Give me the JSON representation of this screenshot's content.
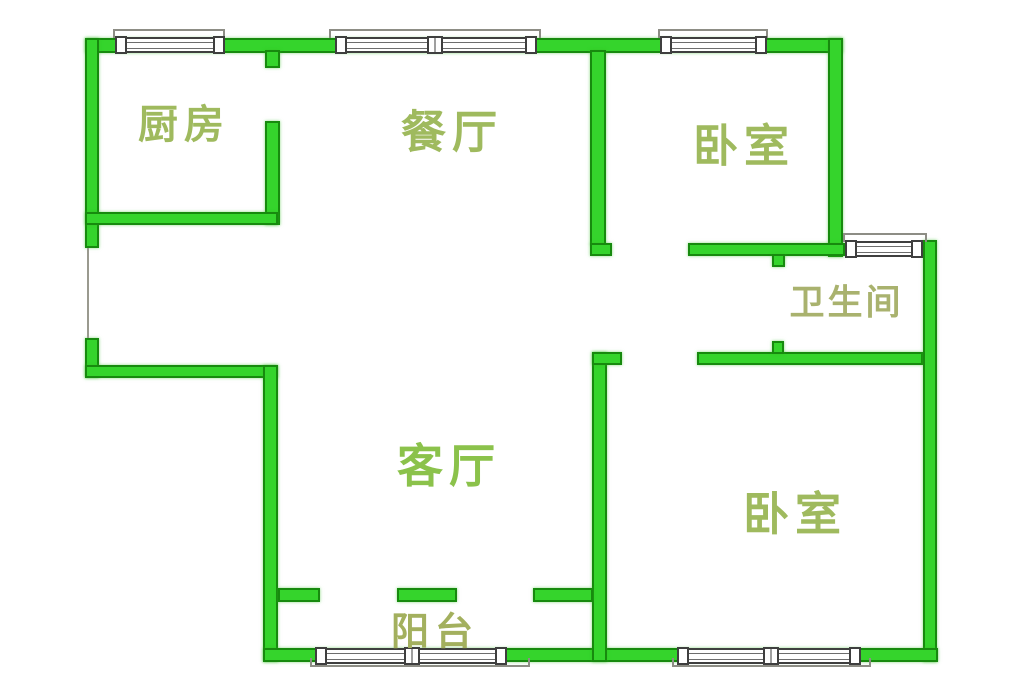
{
  "plan_title": "apartment-floor-plan",
  "rooms": [
    {
      "id": "kitchen",
      "label": "厨房"
    },
    {
      "id": "dining-room",
      "label": "餐厅"
    },
    {
      "id": "bedroom-top",
      "label": "卧室"
    },
    {
      "id": "bathroom",
      "label": "卫生间"
    },
    {
      "id": "living-room",
      "label": "客厅"
    },
    {
      "id": "bedroom-bottom",
      "label": "卧室"
    },
    {
      "id": "balcony",
      "label": "阳台"
    }
  ],
  "colors": {
    "wall_fill": "#35d42c",
    "wall_border": "#178a0e",
    "window_frame": "#3f3f3f",
    "sill_line": "#8d8d85",
    "background": "#ffffff",
    "label_default": "#9fba5e",
    "label_living": "#8bc24b",
    "label_bathroom": "#a9b26e",
    "label_balcony": "#a3b05e"
  }
}
